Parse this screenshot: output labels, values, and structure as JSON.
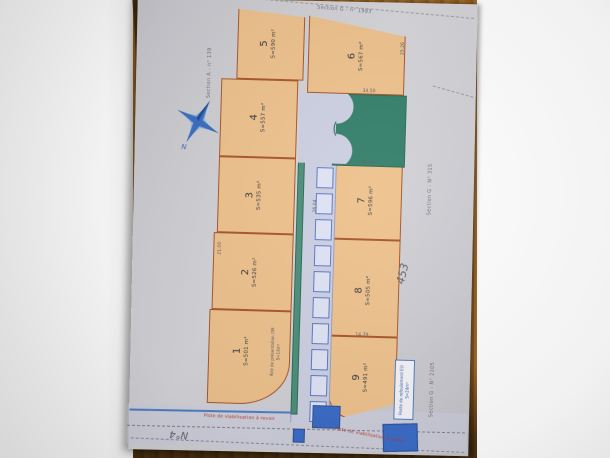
{
  "plots": [
    {
      "num": "1",
      "area": "S=501 m²"
    },
    {
      "num": "2",
      "area": "S=526 m²"
    },
    {
      "num": "3",
      "area": "S=535 m²"
    },
    {
      "num": "4",
      "area": "S=557 m²"
    },
    {
      "num": "5",
      "area": "S=590 m²"
    },
    {
      "num": "6",
      "area": "S=567 m²"
    },
    {
      "num": "7",
      "area": "S=596 m²"
    },
    {
      "num": "8",
      "area": "S=505 m²"
    },
    {
      "num": "9",
      "area": "S=491 m²"
    }
  ],
  "sections": {
    "left": "Section A - n° 139",
    "top": "Section G - n° 1993",
    "right_upper": "Section G - N° 315",
    "right_lower": "Section G - N° 2105"
  },
  "annotations": {
    "aire_line1": "Aire de présentation OM",
    "aire_line2": "S=14m²",
    "poste_line1": "Poste de refoulement EU",
    "poste_line2": "S=24m²",
    "handwritten_number": "453",
    "road_name": "N°4",
    "road_label_1": "Piste de viabilisation à revoir",
    "road_label_2": "Piste de viabilisation à revoir"
  },
  "compass": {
    "label": "N"
  },
  "dims": [
    "34.50",
    "50.50",
    "14.79",
    "21.00",
    "26.04",
    "25.26"
  ],
  "colors": {
    "plot_fill": "#eec28d",
    "plot_border": "#a9572a",
    "green_parcel": "#35806b",
    "road_fill": "#cdd0e2",
    "hatch_blue": "#5b79c9",
    "solid_blue": "#3b6cc7",
    "compass_blue": "#3a6fc0",
    "road_label_red": "#b3392f"
  }
}
